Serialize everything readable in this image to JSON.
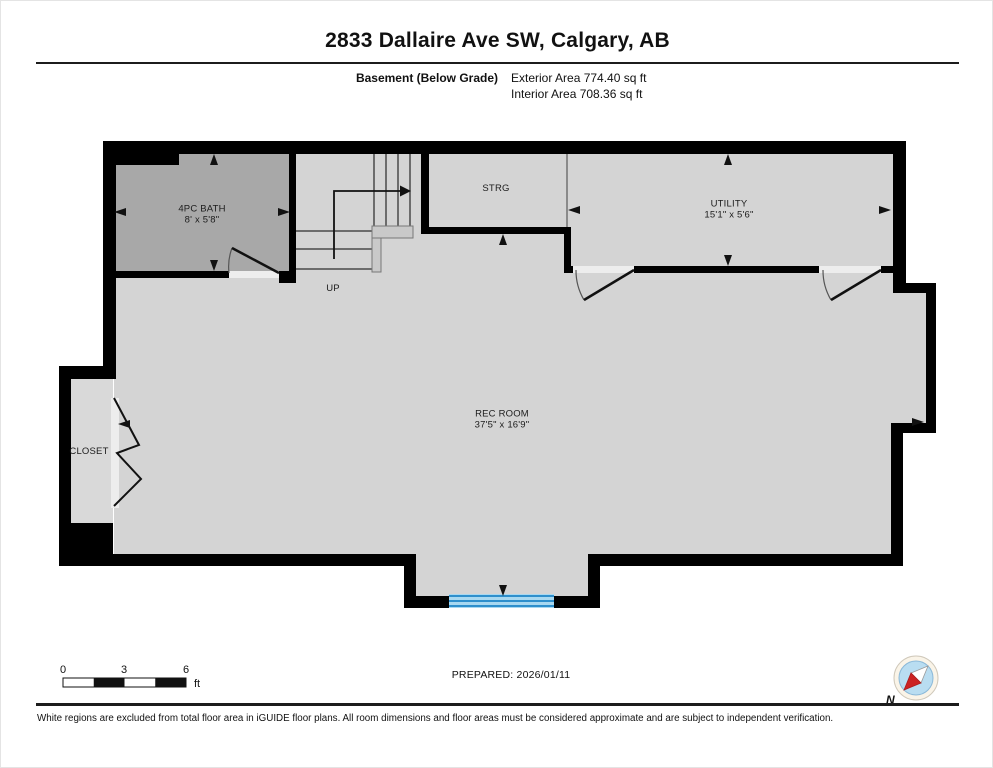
{
  "page": {
    "title": "2833 Dallaire Ave SW, Calgary, AB",
    "floor_label": "Basement (Below Grade)",
    "exterior_area": "Exterior Area 774.40 sq ft",
    "interior_area": "Interior Area 708.36 sq ft",
    "prepared": "PREPARED: 2026/01/11",
    "disclaimer": "White regions are excluded from total floor area in iGUIDE floor plans. All room dimensions and floor areas must be considered approximate and are subject to independent verification."
  },
  "rooms": {
    "bath": {
      "name": "4PC BATH",
      "dims": "8' x 5'8\""
    },
    "strg": {
      "name": "STRG"
    },
    "utility": {
      "name": "UTILITY",
      "dims": "15'1\" x 5'6\""
    },
    "rec": {
      "name": "REC ROOM",
      "dims": "37'5\" x 16'9\""
    },
    "closet": {
      "name": "CLOSET"
    },
    "stairs": {
      "name": "UP"
    }
  },
  "scale_bar": {
    "tick0": "0",
    "tick1": "3",
    "tick2": "6",
    "unit": "ft"
  },
  "compass": {
    "north_label": "N"
  },
  "colors": {
    "wall": "#000000",
    "interior_fill": "#d4d4d4",
    "bath_fill": "#a8a8a8",
    "closet_fill": "#d9d9d9",
    "window_blue": "#2e8fcc",
    "window_fill": "#a8d8f0",
    "compass_red": "#cc2222",
    "compass_blue": "#b9ddf1"
  }
}
